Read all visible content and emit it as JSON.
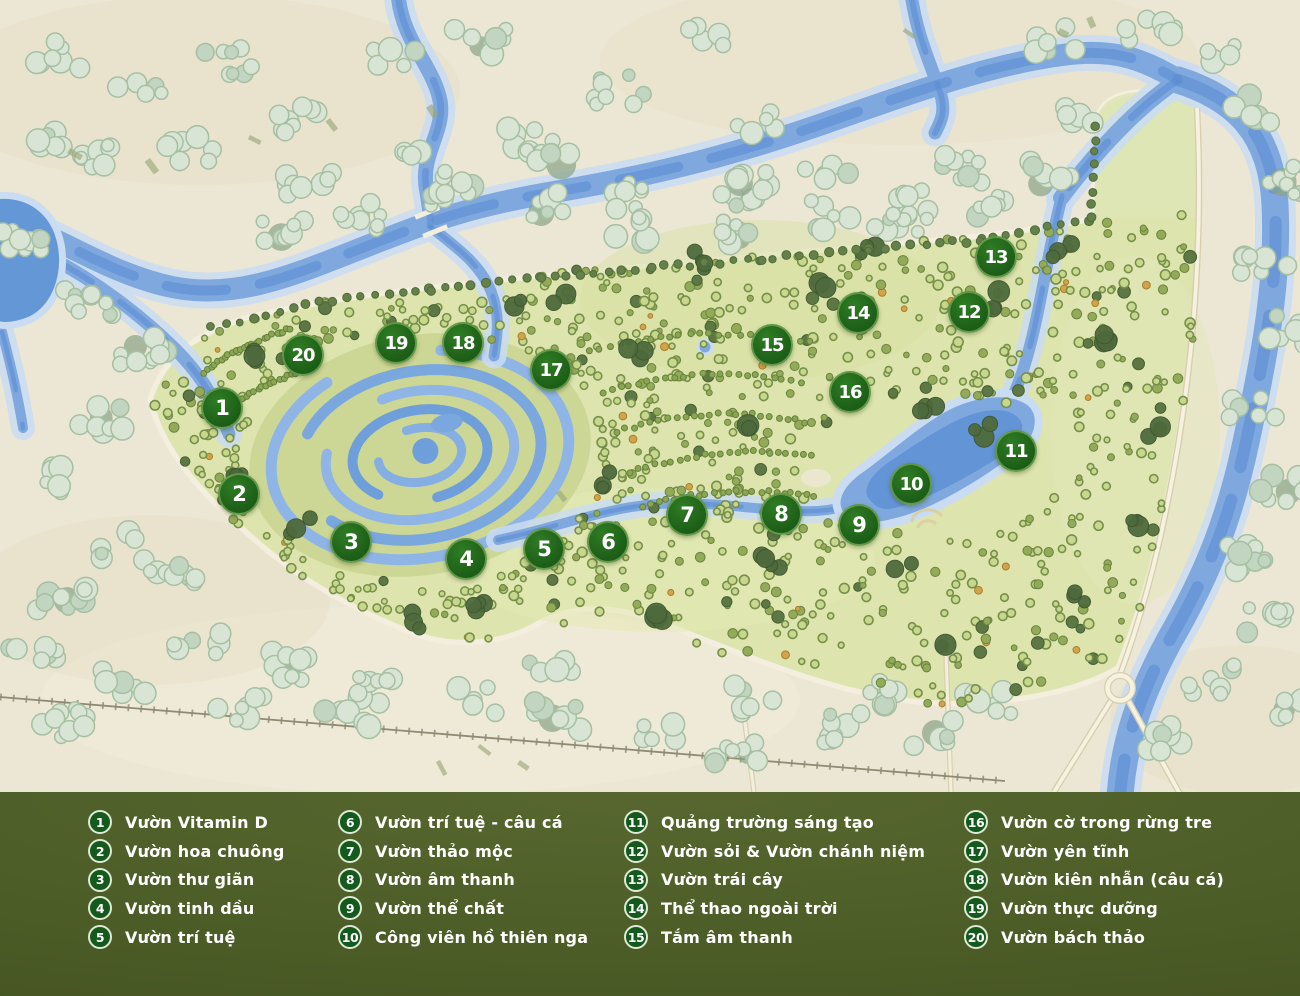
{
  "map": {
    "markers": [
      {
        "n": "1",
        "x": 222,
        "y": 408
      },
      {
        "n": "2",
        "x": 239,
        "y": 494
      },
      {
        "n": "3",
        "x": 351,
        "y": 542
      },
      {
        "n": "4",
        "x": 466,
        "y": 559
      },
      {
        "n": "5",
        "x": 544,
        "y": 549
      },
      {
        "n": "6",
        "x": 608,
        "y": 542
      },
      {
        "n": "7",
        "x": 687,
        "y": 515
      },
      {
        "n": "8",
        "x": 781,
        "y": 514
      },
      {
        "n": "9",
        "x": 859,
        "y": 525
      },
      {
        "n": "10",
        "x": 911,
        "y": 484
      },
      {
        "n": "11",
        "x": 1016,
        "y": 451
      },
      {
        "n": "12",
        "x": 969,
        "y": 312
      },
      {
        "n": "13",
        "x": 996,
        "y": 257
      },
      {
        "n": "14",
        "x": 858,
        "y": 313
      },
      {
        "n": "15",
        "x": 772,
        "y": 345
      },
      {
        "n": "16",
        "x": 850,
        "y": 392
      },
      {
        "n": "17",
        "x": 551,
        "y": 370
      },
      {
        "n": "18",
        "x": 463,
        "y": 343
      },
      {
        "n": "19",
        "x": 396,
        "y": 343
      },
      {
        "n": "20",
        "x": 303,
        "y": 355
      }
    ]
  },
  "legend": {
    "columns": [
      [
        {
          "n": "1",
          "label": "Vườn Vitamin D"
        },
        {
          "n": "2",
          "label": "Vườn hoa chuông"
        },
        {
          "n": "3",
          "label": "Vườn thư giãn"
        },
        {
          "n": "4",
          "label": "Vườn tinh dầu"
        },
        {
          "n": "5",
          "label": "Vườn trí tuệ"
        }
      ],
      [
        {
          "n": "6",
          "label": "Vườn trí tuệ - câu cá"
        },
        {
          "n": "7",
          "label": "Vườn thảo mộc"
        },
        {
          "n": "8",
          "label": "Vườn âm thanh"
        },
        {
          "n": "9",
          "label": "Vườn thể chất"
        },
        {
          "n": "10",
          "label": "Công viên hồ thiên nga"
        }
      ],
      [
        {
          "n": "11",
          "label": "Quảng trường sáng tạo"
        },
        {
          "n": "12",
          "label": "Vườn sỏi & Vườn chánh niệm"
        },
        {
          "n": "13",
          "label": "Vườn trái cây"
        },
        {
          "n": "14",
          "label": "Thể thao ngoài trời"
        },
        {
          "n": "15",
          "label": "Tắm âm thanh"
        }
      ],
      [
        {
          "n": "16",
          "label": "Vườn cờ trong rừng tre"
        },
        {
          "n": "17",
          "label": "Vườn yên tĩnh"
        },
        {
          "n": "18",
          "label": "Vườn kiên nhẫn (câu cá)"
        },
        {
          "n": "19",
          "label": "Vườn thực dưỡng"
        },
        {
          "n": "20",
          "label": "Vườn bách thảo"
        }
      ]
    ]
  },
  "colors": {
    "marker_green": "#1c5d17",
    "legend_bg": "#4b5b26",
    "river_blue": "#7fa9de",
    "park_green": "#dde4ad",
    "background_cream": "#ece7d4"
  }
}
